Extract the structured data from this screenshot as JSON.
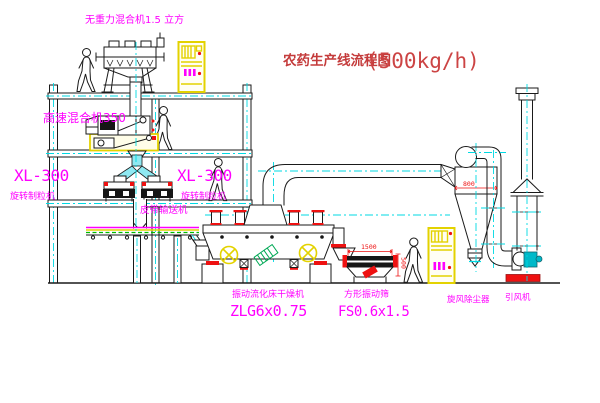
{
  "title": {
    "main": "农药生产线流程图",
    "capacity": "(500kg/h)"
  },
  "labels": {
    "gravity_mixer": "无重力混合机1.5 立方",
    "high_speed_mixer": "高速混合机350",
    "granulator_left_model": "XL-300",
    "granulator_left_name": "旋转制粒机",
    "granulator_right_model": "XL-300",
    "granulator_right_name": "旋转制粒机",
    "belt_conveyor": "皮带输送机",
    "fluid_bed_dryer_name": "振动流化床干燥机",
    "fluid_bed_dryer_model": "ZLG6x0.75",
    "vibrating_sieve_name": "方形振动筛",
    "vibrating_sieve_model": "FS0.6x1.5",
    "cyclone_dust_collector": "旋风除尘器",
    "induced_draft_fan": "引风机"
  },
  "dimensions": {
    "sieve_length": "1500",
    "cyclone_width": "800",
    "sieve_outlet_height": "500"
  },
  "colors": {
    "label_magenta": "#FF00FF",
    "title_red": "#C43B3B",
    "dimension_red": "#EE1111",
    "centerline_cyan": "#00D9E3",
    "cabinet_yellow": "#E3D200",
    "machine_teal": "#00B9C9",
    "belt_green": "#00BB00"
  }
}
